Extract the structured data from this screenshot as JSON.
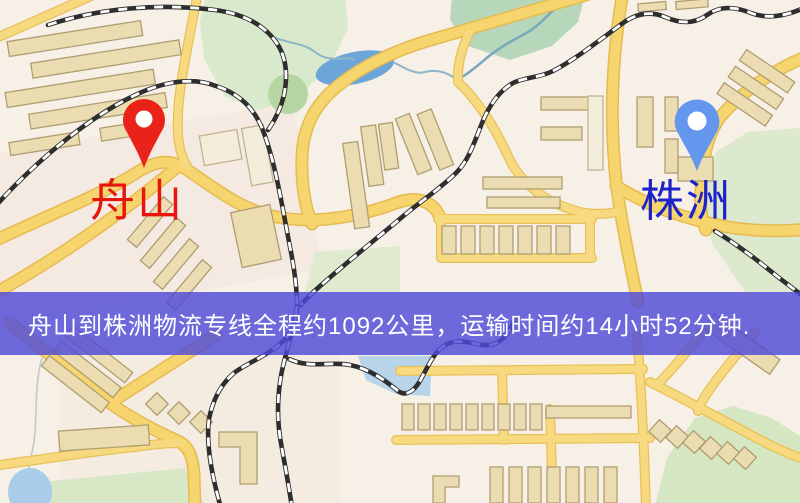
{
  "banner": {
    "text": "舟山到株洲物流专线全程约1092公里，运输时间约14小时52分钟.",
    "background": "#4f4ad8",
    "text_color": "#ffffff"
  },
  "markers": {
    "origin": {
      "label": "舟山",
      "pin_color": "#e9231a",
      "label_color": "#e8150c"
    },
    "destination": {
      "label": "株洲",
      "pin_color": "#6496ee",
      "label_color": "#1c23c8"
    }
  },
  "map": {
    "background": "#f6f0e6",
    "road_color": "#f6d56f",
    "railway_color": "#2e2e2e",
    "park_color": "#d9e9cc",
    "water_color": "#6ca6d8",
    "building_color": "#ecdcb2"
  }
}
